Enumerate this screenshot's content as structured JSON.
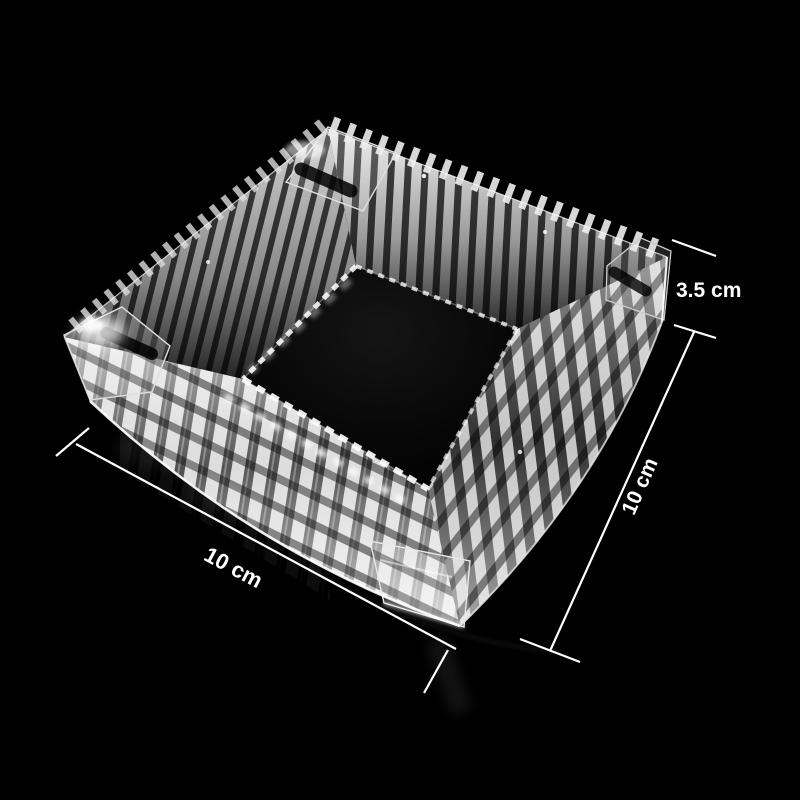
{
  "scene": {
    "subject": "crystal glass square ashtray",
    "background_color": "#000000"
  },
  "dimensions": {
    "annotation_color": "#ffffff",
    "height": {
      "label": "3.5 cm"
    },
    "depth": {
      "label": "10 cm"
    },
    "width": {
      "label": "10 cm"
    }
  }
}
